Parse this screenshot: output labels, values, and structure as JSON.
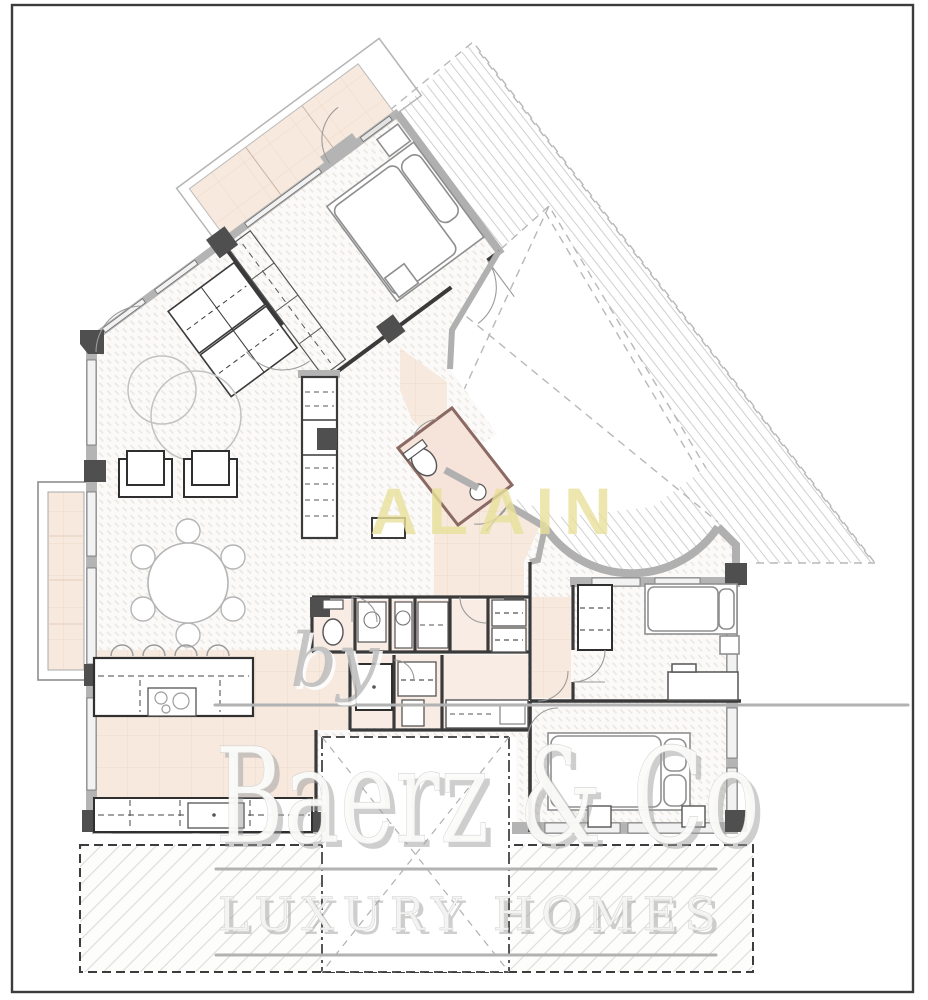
{
  "watermark": {
    "prefix": "by",
    "brand": "Baerz & Co",
    "tagline": "LUXURY HOMES",
    "agent_mark": "ALAIN"
  },
  "colors": {
    "agent_yellow": "#e9e19b",
    "watermark_fill": "#fbfbfa",
    "watermark_shadow": "#9f9f9f",
    "rule_gray": "#b2b2b2",
    "floor_tint": "#f7e9dd",
    "wall_gray": "#b4b4b4",
    "wall_dark": "#3a3a3a",
    "pillar_dark": "#4f4f4f",
    "frame_border": "#3c3c3c",
    "hatch_gray": "#d0d0d0"
  }
}
